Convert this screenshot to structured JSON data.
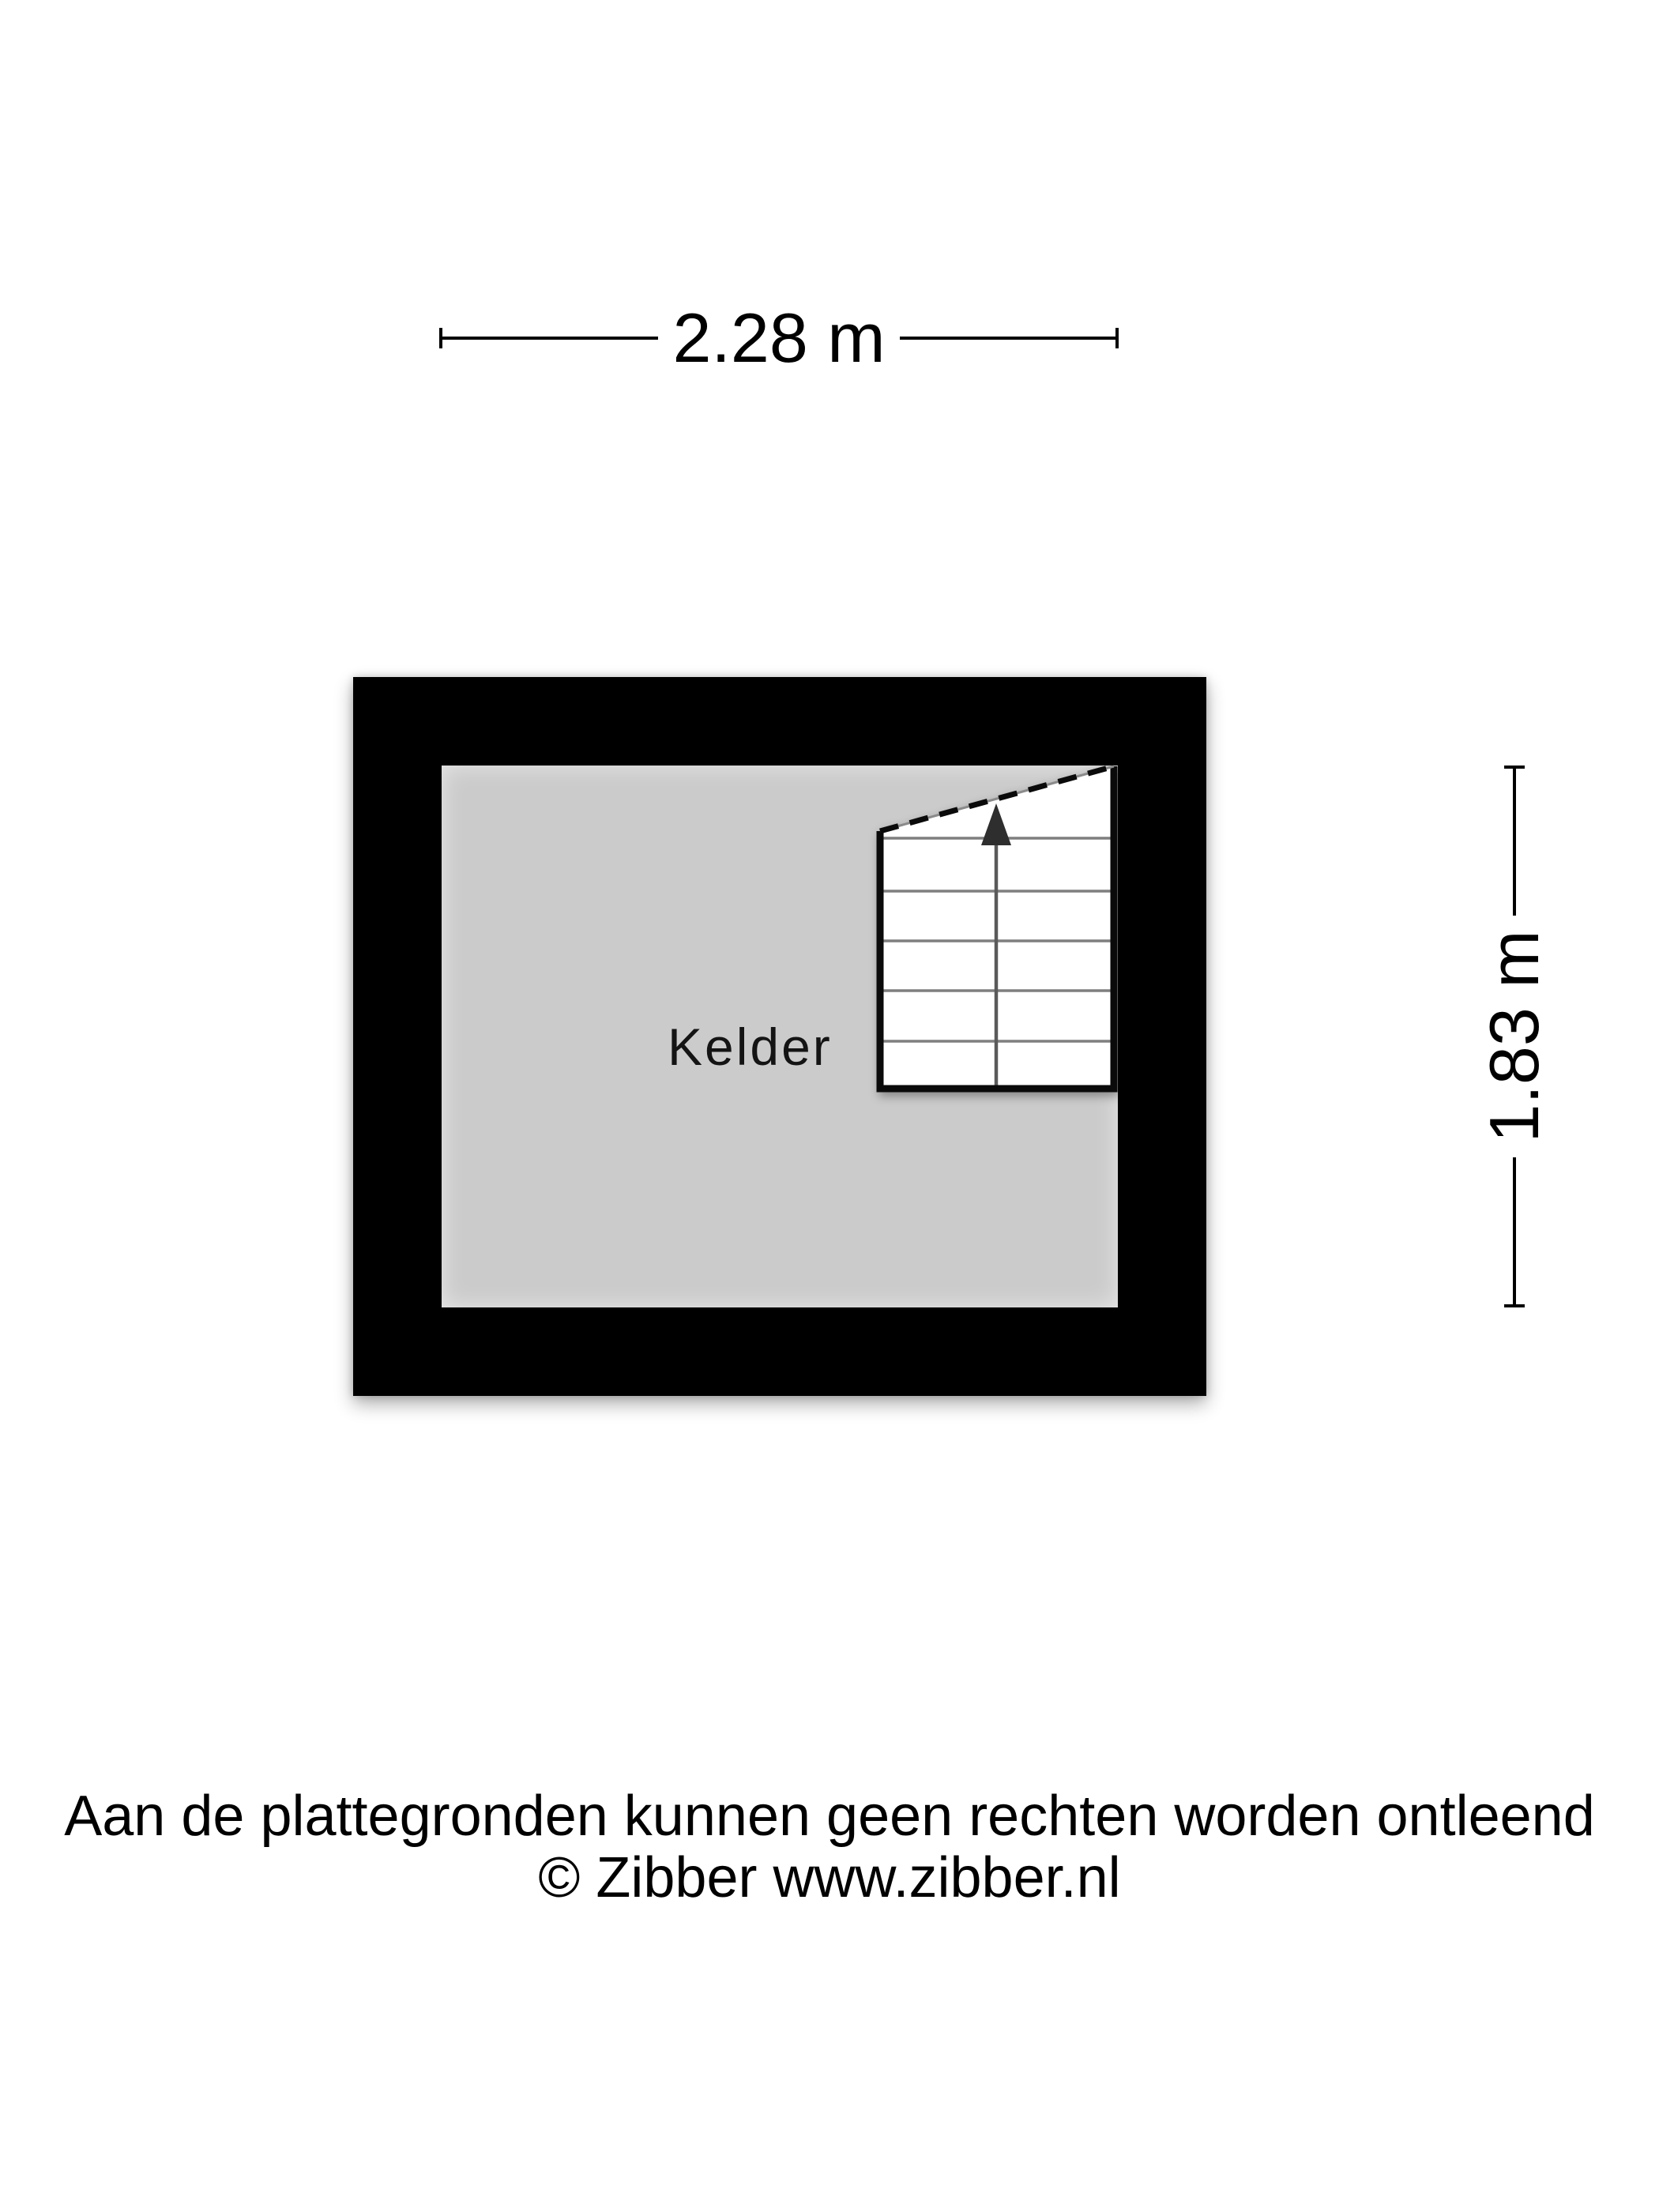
{
  "dimensions": {
    "width_label": "2.28 m",
    "height_label": "1.83 m"
  },
  "room": {
    "label": "Kelder"
  },
  "footer": {
    "disclaimer": "Aan de plattegronden kunnen geen rechten worden ontleend",
    "copyright": "© Zibber www.zibber.nl"
  },
  "colors": {
    "wall": "#000000",
    "floor": "#cbcbcb",
    "stairs_fill": "#ffffff",
    "stairs_border": "#0a0a0a",
    "tread_line": "#7f7f7f",
    "stem": "#5a5a5a",
    "arrow": "#2e2e2e",
    "dim_line": "#000000",
    "text": "#000000"
  }
}
